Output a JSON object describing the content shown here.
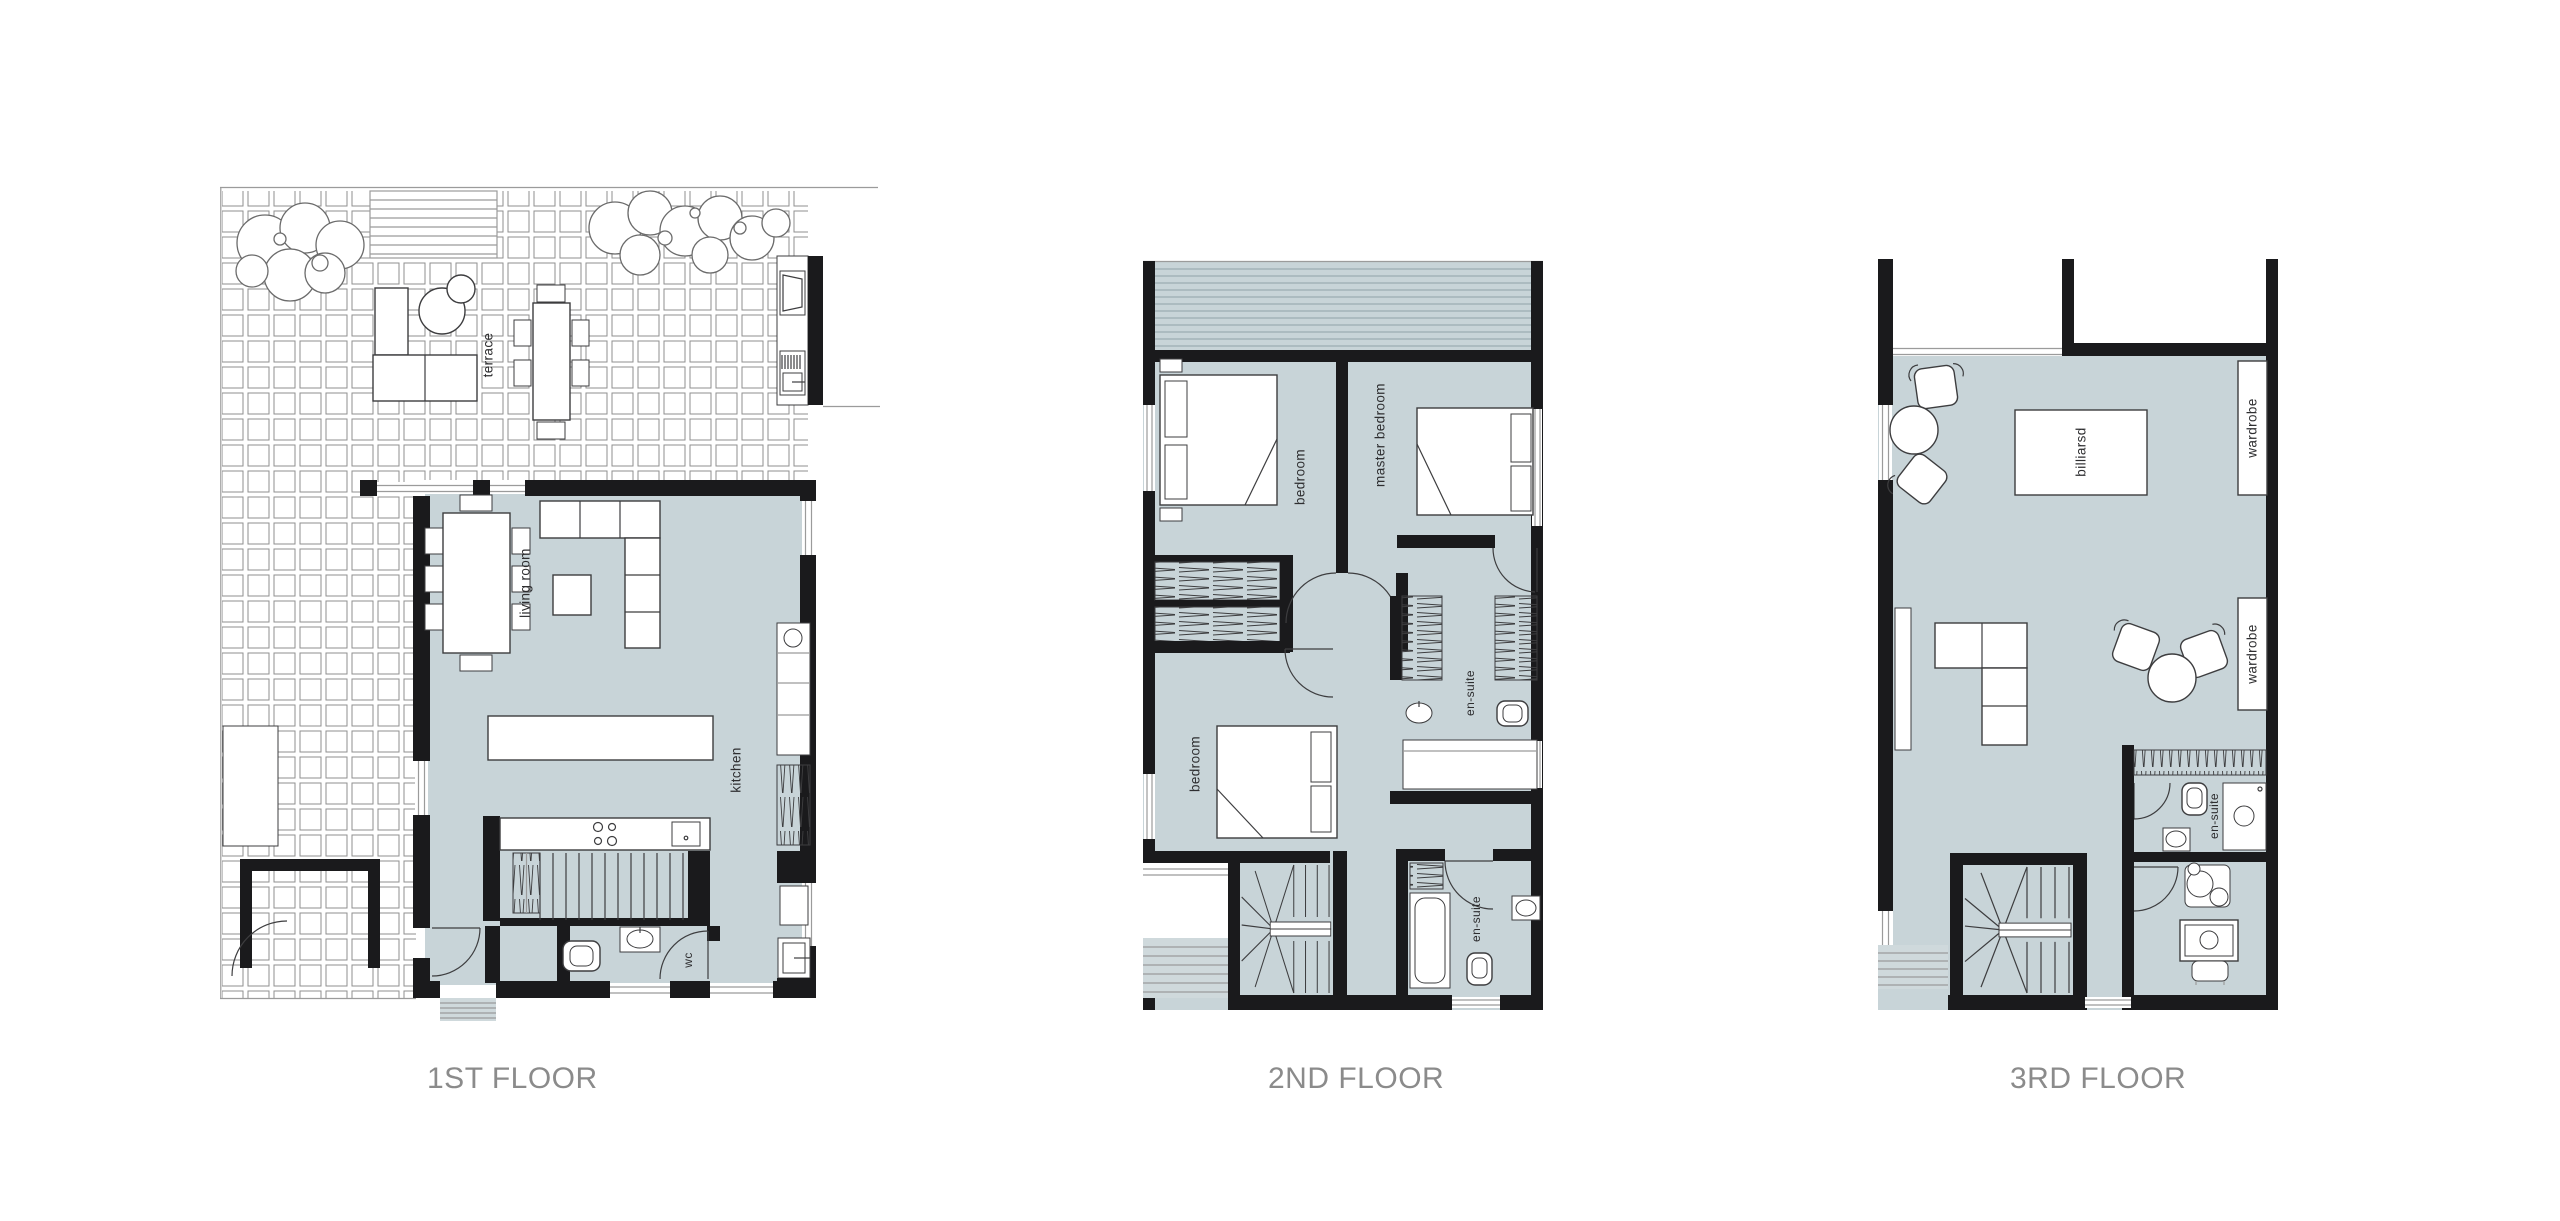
{
  "page": {
    "background": "#ffffff"
  },
  "colors": {
    "room_fill": "#c8d4d8",
    "wall": "#1a1a1c",
    "line": "#3d3d3f",
    "thin_line": "#9b9b9b",
    "tile_line": "#8f8f8f",
    "label_text": "#2e2e30",
    "title_text": "#8b8b8b",
    "steps_fill": "#cfd9dc",
    "stripe_line": "#8fa2a7"
  },
  "floors": [
    {
      "id": "floor-1",
      "title": "1ST FLOOR",
      "rooms": [
        {
          "label": "terrace"
        },
        {
          "label": "living room"
        },
        {
          "label": "kitchen"
        },
        {
          "label": "wc"
        }
      ]
    },
    {
      "id": "floor-2",
      "title": "2ND FLOOR",
      "rooms": [
        {
          "label": "bedroom"
        },
        {
          "label": "master bedroom"
        },
        {
          "label": "en-suite"
        },
        {
          "label": "bedroom"
        },
        {
          "label": "en-suite"
        }
      ]
    },
    {
      "id": "floor-3",
      "title": "3RD FLOOR",
      "rooms": [
        {
          "label": "billiarsd"
        },
        {
          "label": "wardrobe"
        },
        {
          "label": "wardrobe"
        },
        {
          "label": "en-suite"
        }
      ]
    }
  ]
}
